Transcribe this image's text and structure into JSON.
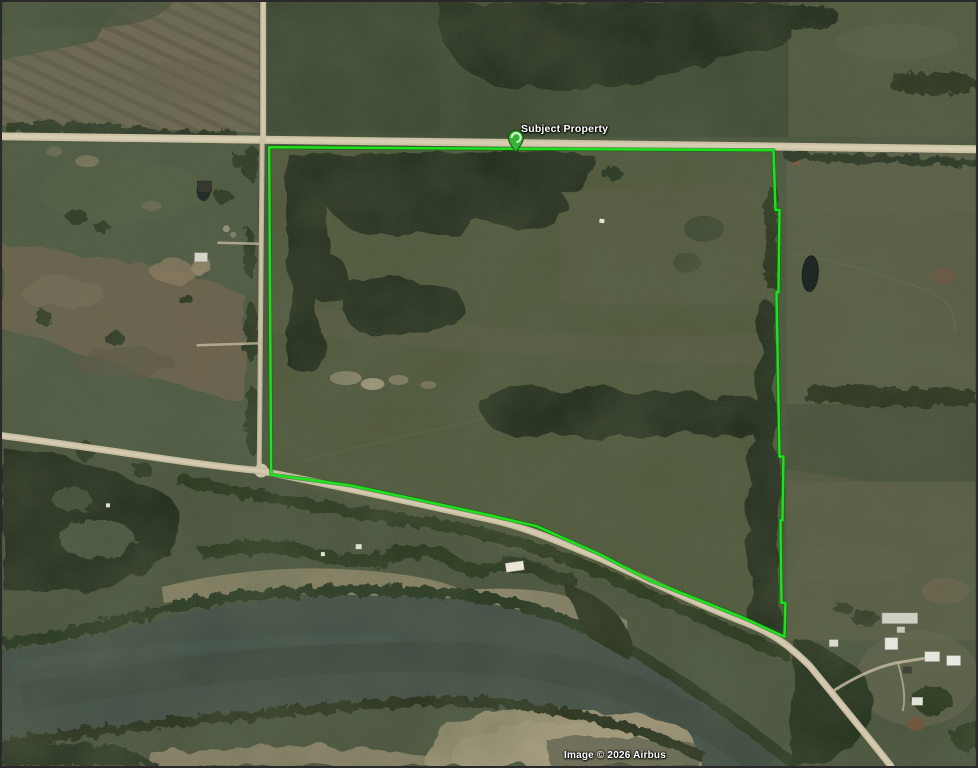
{
  "annotation": {
    "subject_label": "Subject Property",
    "boundary_color": "#1de31d",
    "boundary_points": "268,146 775,149 777,209 781,209 780,292 778,292 781,457 785,457 784,521 782,521 783,604 787,604 786,638 747,620 700,601 652,582 600,555 537,527 490,516 430,503 350,486 270,475",
    "marker_transform": "translate(516,151)"
  },
  "attribution": {
    "text": "Image © 2026 Airbus"
  }
}
